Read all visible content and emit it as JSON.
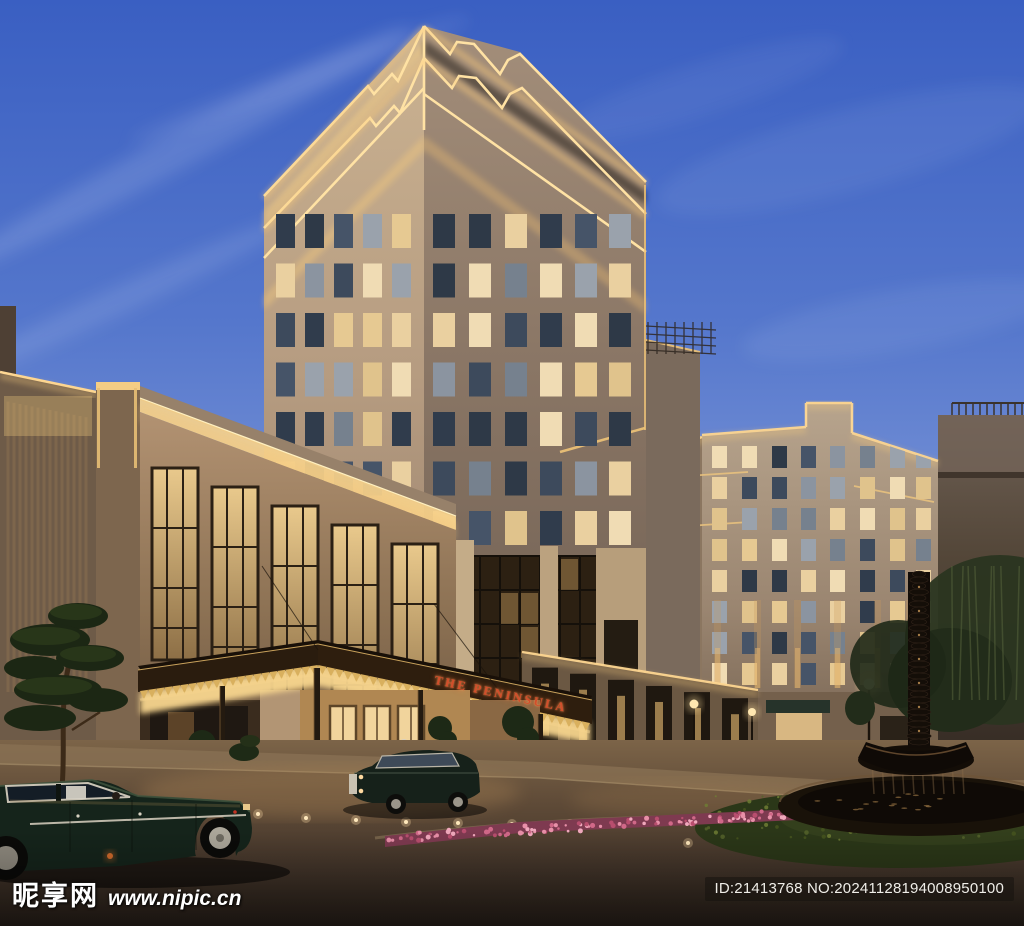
{
  "canopy_sign": {
    "text": "THE PENINSULA",
    "color": "#d24e2b"
  },
  "watermark": {
    "site_name": "昵享网",
    "site_url": "www.nipic.cn"
  },
  "id_badge": {
    "text": "ID:21413768 NO:20241128194008950100"
  },
  "palette": {
    "sky_top": "#3a5fc2",
    "sky_horizon": "#a9b4e2",
    "facade_gold": "#ffd98f",
    "stone_warm": "#c9b190",
    "stone_shadow": "#6f5f52",
    "window_lit": "#ead0a0",
    "window_dark": "#3d4a5c",
    "canopy_fringe": "#d9b05e",
    "foliage_dark": "#1c2714",
    "flower_pink": "#d06888",
    "pavement_dark": "#2e241c",
    "car_green": "#16211a",
    "fountain_bronze": "#140e08"
  }
}
